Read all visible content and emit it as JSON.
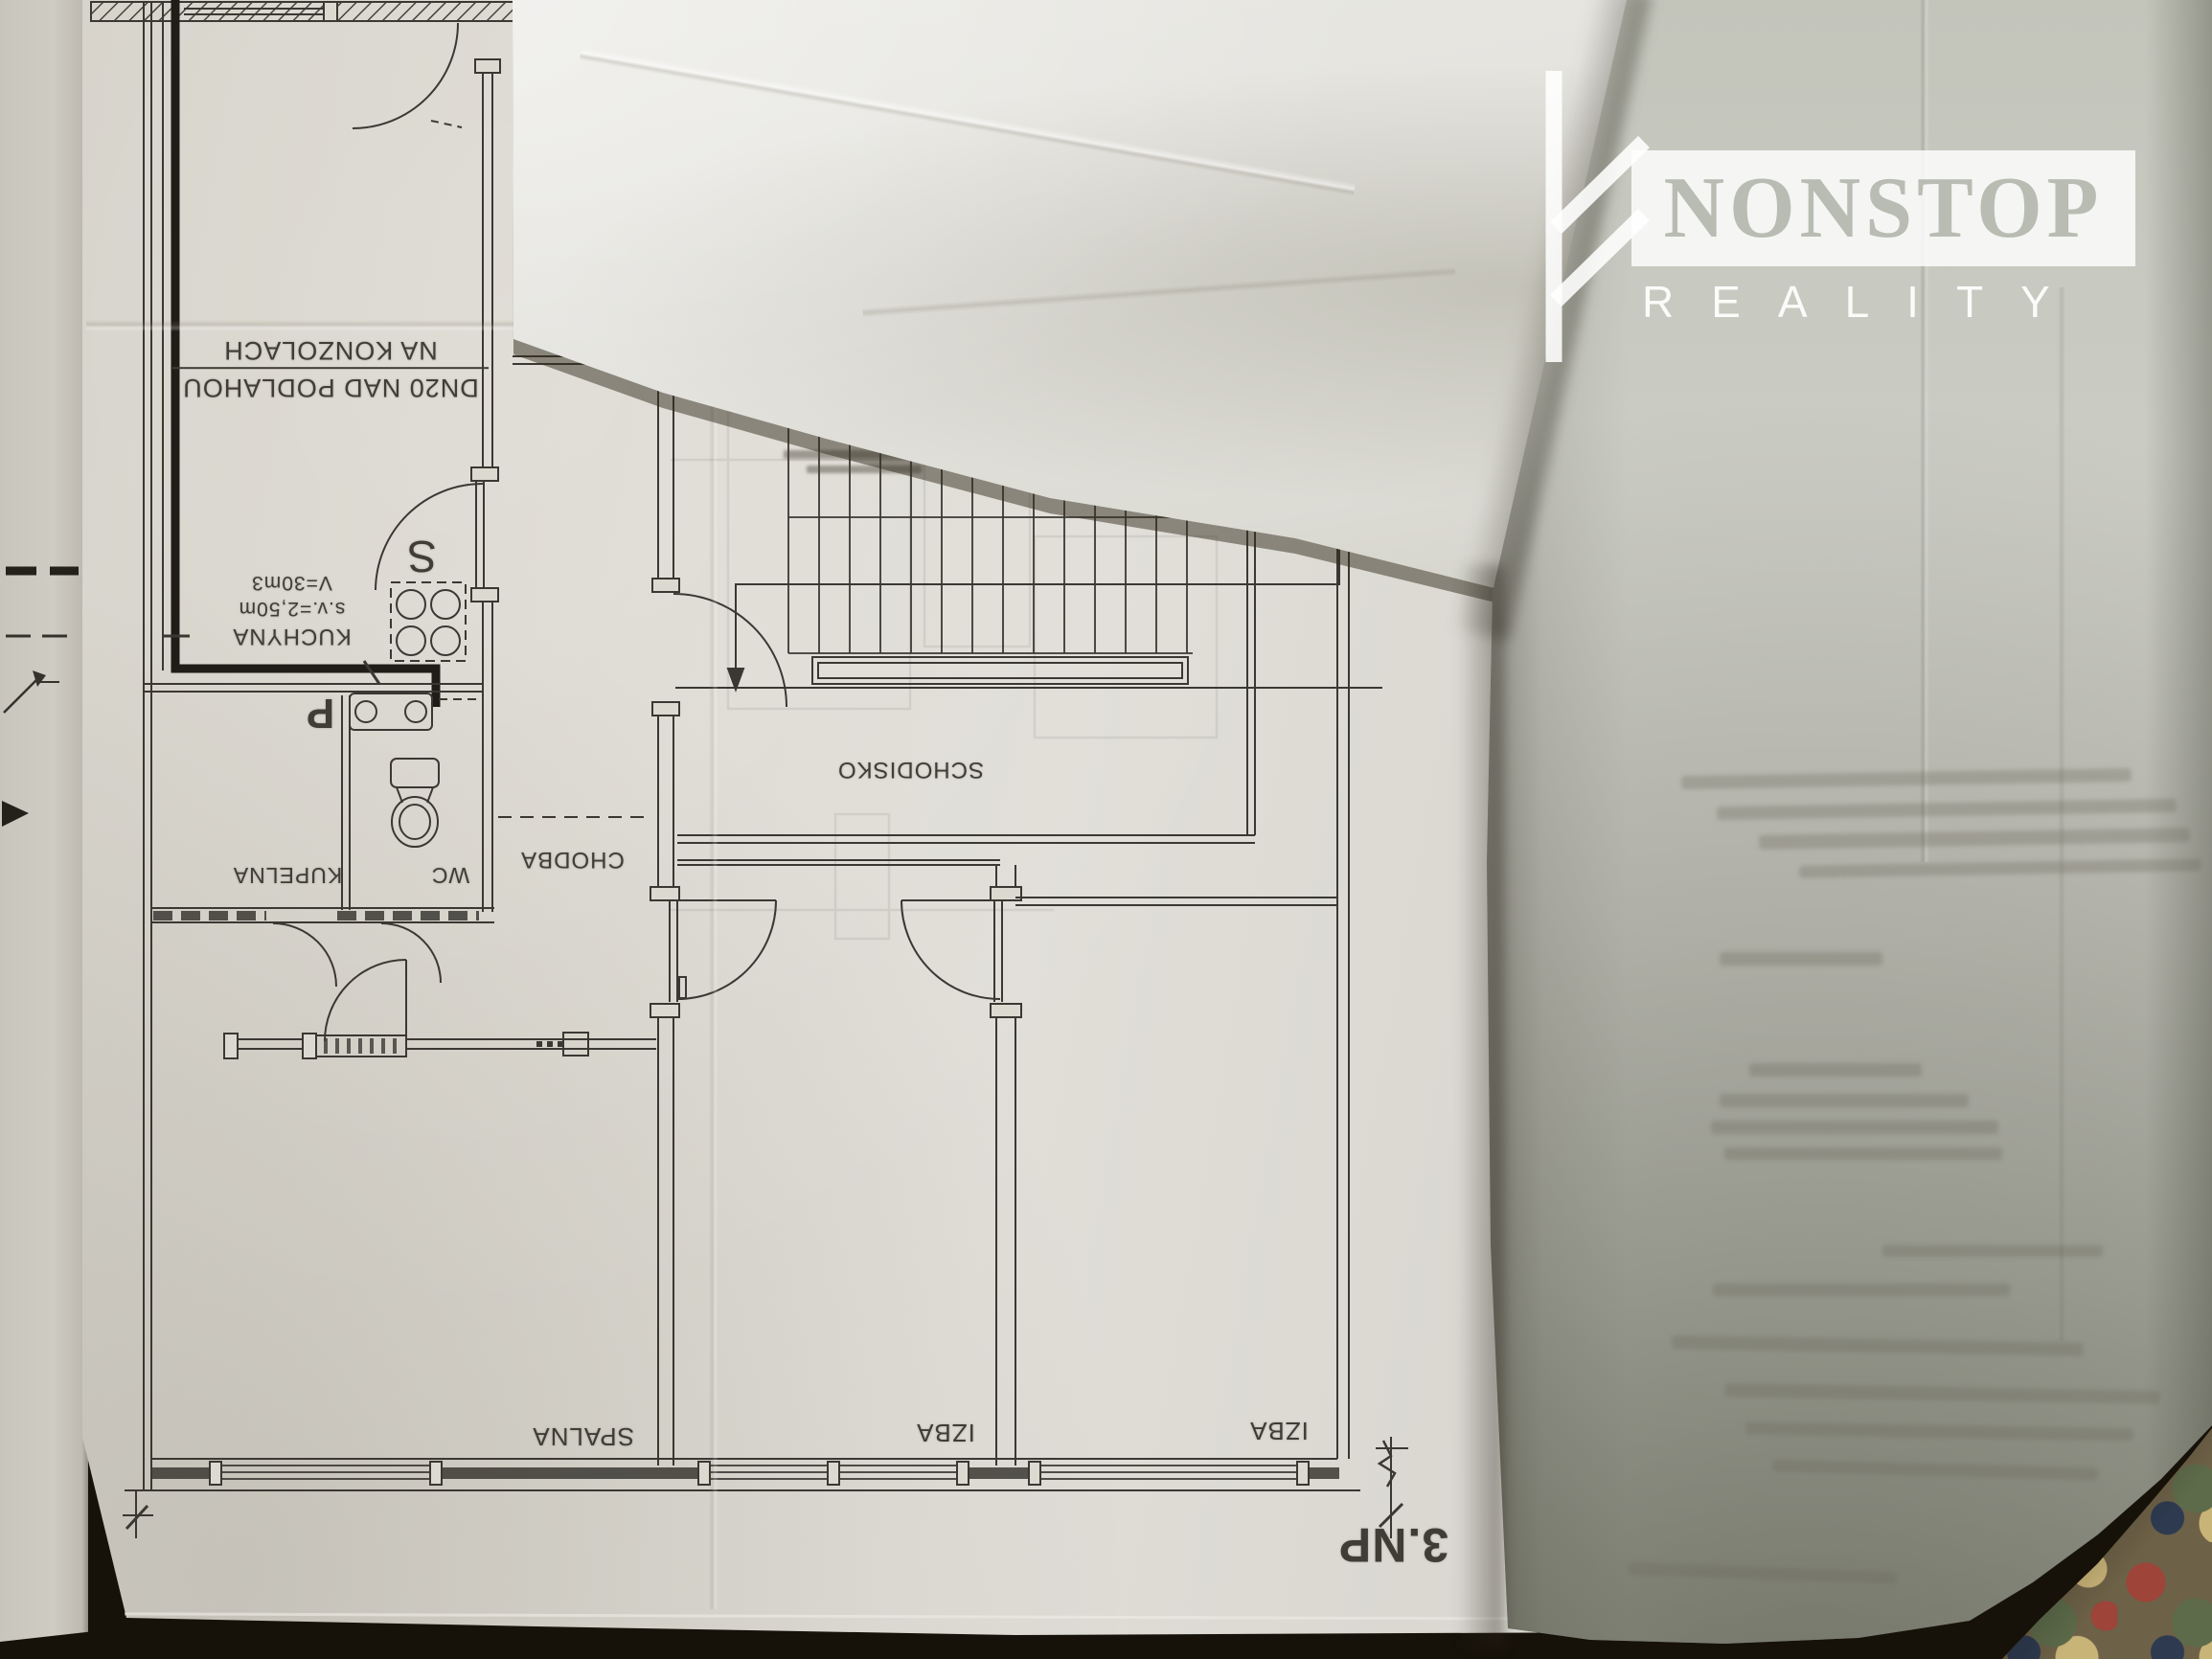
{
  "brand": {
    "name": "NONSTOP",
    "subtitle": "REALITY",
    "symbol": "futhark-f-rune"
  },
  "plan": {
    "floor_label": "3.NP",
    "pipe_note_line1": "DN20 NAD PODLAHOU",
    "pipe_note_line2": "NA KONZOLACH",
    "kitchen": {
      "label": "KUCHYNA",
      "ceiling_height": "s.v.=2,50m",
      "volume": "V=30m3",
      "stove_label": "S",
      "sink_label": "P"
    },
    "rooms": {
      "bathroom": "KUPELNA",
      "wc": "WC",
      "hall": "CHODBA",
      "staircase": "SCHODISKO",
      "bedroom": "SPALNA",
      "room_mid": "IZBA",
      "room_right": "IZBA"
    }
  },
  "colors": {
    "paper_plan": "#dbd8d0",
    "paper_left": "#cfccc3",
    "paper_top": "#e6e5e0",
    "paper_right": "#c6c8bd",
    "ink": "#3b3833",
    "ink_heavy": "#211e18",
    "background": "#171209",
    "brand_text": "#b8bcb2",
    "carpet_base": "#6d6147",
    "carpet_red": "#9e4438",
    "carpet_green": "#5d6b4a",
    "carpet_tan": "#c9b478",
    "carpet_navy": "#2e3a50"
  }
}
